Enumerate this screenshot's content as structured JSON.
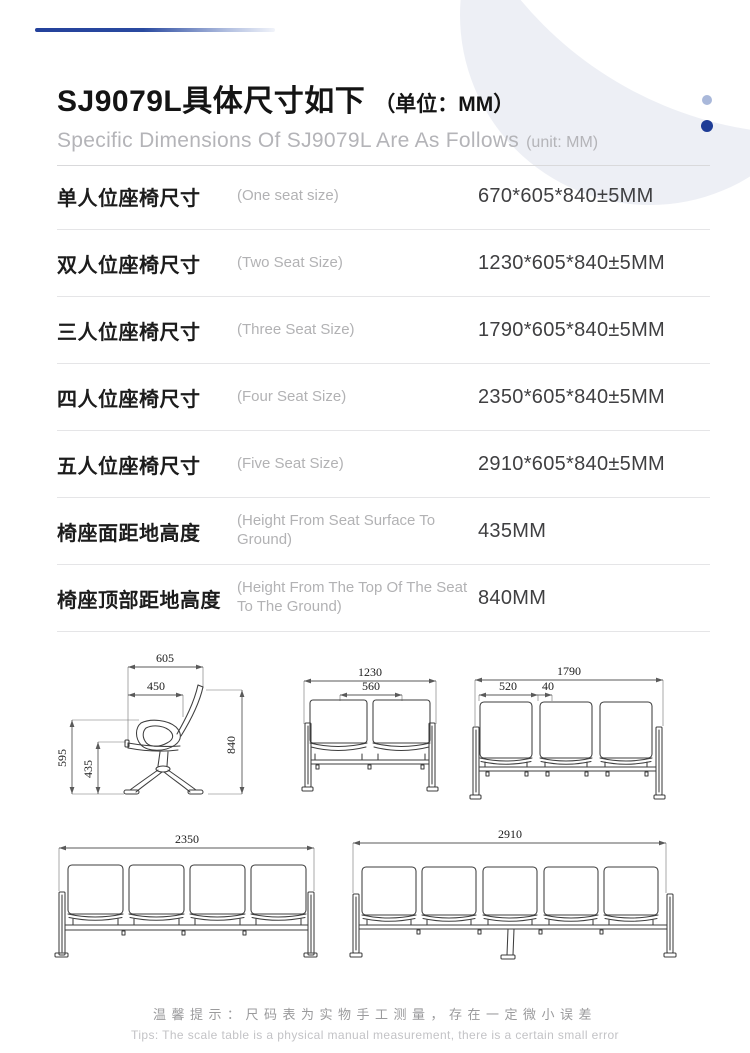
{
  "header": {
    "title_zh": "SJ9079L具体尺寸如下",
    "title_unit_zh": "（单位：MM）",
    "subtitle_en": "Specific Dimensions Of SJ9079L Are As Follows",
    "subtitle_unit_en": "(unit: MM)"
  },
  "spec_table": {
    "rows": [
      {
        "label_zh": "单人位座椅尺寸",
        "label_en": "(One seat size)",
        "value": "670*605*840±5MM"
      },
      {
        "label_zh": "双人位座椅尺寸",
        "label_en": "(Two Seat Size)",
        "value": "1230*605*840±5MM"
      },
      {
        "label_zh": "三人位座椅尺寸",
        "label_en": "(Three Seat Size)",
        "value": "1790*605*840±5MM"
      },
      {
        "label_zh": "四人位座椅尺寸",
        "label_en": "(Four Seat Size)",
        "value": "2350*605*840±5MM"
      },
      {
        "label_zh": "五人位座椅尺寸",
        "label_en": "(Five Seat Size)",
        "value": "2910*605*840±5MM"
      },
      {
        "label_zh": "椅座面距地高度",
        "label_en": "(Height From Seat Surface To Ground)",
        "value": "435MM"
      },
      {
        "label_zh": "椅座顶部距地高度",
        "label_en": "(Height From The Top Of The Seat To The Ground)",
        "value": "840MM"
      }
    ]
  },
  "drawings": {
    "single_side_view": {
      "width_overall": "605",
      "seat_depth": "450",
      "height_overall": "840",
      "armrest_height": "595",
      "seat_height": "435"
    },
    "two_seat_front": {
      "width_overall": "1230",
      "seat_width": "560"
    },
    "three_seat_front": {
      "width_overall": "1790",
      "seat_width": "520",
      "seat_gap": "40"
    },
    "four_seat_front": {
      "width_overall": "2350"
    },
    "five_seat_front": {
      "width_overall": "2910"
    }
  },
  "footer": {
    "tip_zh": "温馨提示：尺码表为实物手工测量，存在一定微小误差",
    "tip_en": "Tips: The scale table is a physical manual measurement, there is a certain small error"
  },
  "colors": {
    "accent_dark_blue": "#24419b",
    "accent_light_blue": "#a9b8da",
    "deco_circle_gray": "#edeff5",
    "rule_gray": "#e5e5e7",
    "text_dark": "#1c1c1c",
    "text_gray": "#b2b2b4",
    "drawing_line": "#3e3e3e"
  }
}
